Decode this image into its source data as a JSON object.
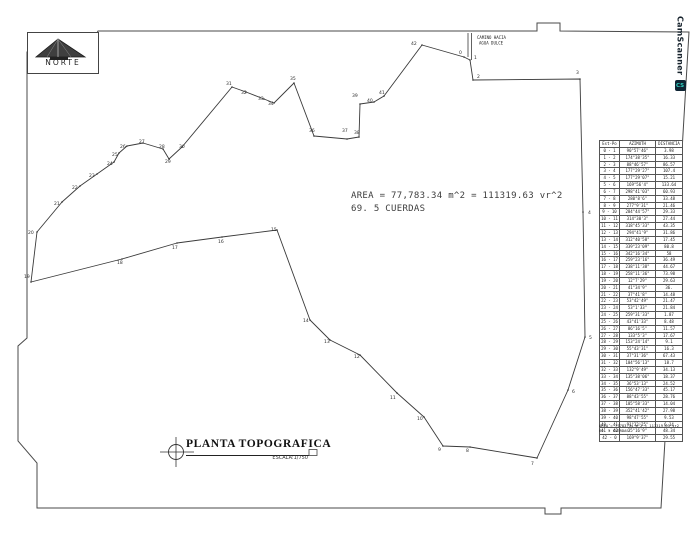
{
  "north": {
    "label": "NORTE"
  },
  "road": {
    "line1": "CAMINO HACIA",
    "line2": "AGUA DULCE"
  },
  "area_note": {
    "line1": "AREA = 77,783.34 m^2 = 111319.63 vr^2",
    "line2": "69. 5 CUERDAS"
  },
  "title_block": {
    "title": "PLANTA TOPOGRAFICA",
    "scale": "ESCALA:1/750"
  },
  "watermark": {
    "brand": "CamScanner",
    "icon": "CS"
  },
  "survey_table": {
    "headers": [
      "Est-Po",
      "AZIMUTH",
      "DISTANCIA"
    ],
    "rows": [
      [
        "0 - 1",
        "90°57'46\"",
        "3.98"
      ],
      [
        "1 - 2",
        "174°38'35\"",
        "16.33"
      ],
      [
        "2 - 3",
        "88°46'57\"",
        "86.57"
      ],
      [
        "3 - 4",
        "177°29'27\"",
        "107.4"
      ],
      [
        "4 - 5",
        "177°29'07\"",
        "15.21"
      ],
      [
        "5 - 6",
        "169°56'4\"",
        "133.64"
      ],
      [
        "6 - 7",
        "298°41'03\"",
        "60.93"
      ],
      [
        "7 - 8",
        "280°8'6\"",
        "33.48"
      ],
      [
        "8 - 9",
        "277°9'31\"",
        "21.46"
      ],
      [
        "9 - 10",
        "284°44'57\"",
        "29.33"
      ],
      [
        "10 - 11",
        "314°30'3\"",
        "27.44"
      ],
      [
        "11 - 12",
        "318°45'33\"",
        "43.35"
      ],
      [
        "12 - 13",
        "294°41'9\"",
        "31.86"
      ],
      [
        "13 - 14",
        "312°40'58\"",
        "17.45"
      ],
      [
        "14 - 15",
        "339°23'09\"",
        "80.8"
      ],
      [
        "15 - 16",
        "342°16'34\"",
        "58"
      ],
      [
        "16 - 17",
        "259°23'16\"",
        "36.49"
      ],
      [
        "17 - 18",
        "238°11'38\"",
        "44.67"
      ],
      [
        "18 - 19",
        "258°11'36\"",
        "73.98"
      ],
      [
        "19 - 20",
        "12°7'29\"",
        "29.63"
      ],
      [
        "20 - 21",
        "41°34'9\"",
        "36."
      ],
      [
        "21 - 22",
        "37°41'8\"",
        "14.48"
      ],
      [
        "22 - 23",
        "53°42'49\"",
        "21.47"
      ],
      [
        "23 - 24",
        "53°1'33\"",
        "21.84"
      ],
      [
        "24 - 25",
        "259°31'33\"",
        "1.87"
      ],
      [
        "25 - 26",
        "43°41'33\"",
        "8.48"
      ],
      [
        "26 - 27",
        "86°16'5\"",
        "11.57"
      ],
      [
        "27 - 28",
        "133°5'3\"",
        "17.67"
      ],
      [
        "28 - 29",
        "153°24'14\"",
        "9.1"
      ],
      [
        "29 - 30",
        "55°43'31\"",
        "16.3"
      ],
      [
        "30 - 31",
        "37°31'36\"",
        "67.43"
      ],
      [
        "31 - 32",
        "104°56'13\"",
        "18.7"
      ],
      [
        "32 - 33",
        "132°9'49\"",
        "34.13"
      ],
      [
        "33 - 34",
        "135°38'06\"",
        "18.37"
      ],
      [
        "34 - 35",
        "36°53'13\"",
        "24.52"
      ],
      [
        "35 - 36",
        "156°47'33\"",
        "45.17"
      ],
      [
        "36 - 37",
        "88°43'55\"",
        "28.76"
      ],
      [
        "37 - 38",
        "105°58'33\"",
        "14.04"
      ],
      [
        "38 - 39",
        "352°41'42\"",
        "27.98"
      ],
      [
        "39 - 40",
        "98°47'55\"",
        "9.53"
      ],
      [
        "40 - 41",
        "91°32'25\"",
        "6.14"
      ],
      [
        "41 - 42",
        "35°16'9\"",
        "48.34"
      ],
      [
        "42 - 0",
        "169°9'37\"",
        "29.55"
      ]
    ],
    "footer_line1": "AREA = 77783.34 m^2 = 111319.63 vr2",
    "footer_line2": "69. 5 CUERDAS"
  },
  "plot": {
    "stroke": "#3a3a3a",
    "vertices": [
      {
        "n": "0",
        "x": 464,
        "y": 57,
        "lx": 459,
        "ly": 54
      },
      {
        "n": "1",
        "x": 470,
        "y": 60,
        "lx": 474,
        "ly": 59
      },
      {
        "n": "2",
        "x": 473,
        "y": 80,
        "lx": 477,
        "ly": 78
      },
      {
        "n": "3",
        "x": 580,
        "y": 79,
        "lx": 576,
        "ly": 74
      },
      {
        "n": "4",
        "x": 583,
        "y": 212,
        "lx": 588,
        "ly": 214
      },
      {
        "n": "5",
        "x": 585,
        "y": 337,
        "lx": 589,
        "ly": 339
      },
      {
        "n": "6",
        "x": 568,
        "y": 390,
        "lx": 572,
        "ly": 393
      },
      {
        "n": "7",
        "x": 537,
        "y": 458,
        "lx": 531,
        "ly": 465
      },
      {
        "n": "8",
        "x": 470,
        "y": 447,
        "lx": 466,
        "ly": 452
      },
      {
        "n": "9",
        "x": 443,
        "y": 446,
        "lx": 438,
        "ly": 451
      },
      {
        "n": "10",
        "x": 424,
        "y": 417,
        "lx": 417,
        "ly": 420
      },
      {
        "n": "11",
        "x": 397,
        "y": 393,
        "lx": 390,
        "ly": 399
      },
      {
        "n": "12",
        "x": 360,
        "y": 355,
        "lx": 354,
        "ly": 358
      },
      {
        "n": "13",
        "x": 330,
        "y": 340,
        "lx": 324,
        "ly": 343
      },
      {
        "n": "14",
        "x": 310,
        "y": 320,
        "lx": 303,
        "ly": 322
      },
      {
        "n": "15",
        "x": 277,
        "y": 230,
        "lx": 271,
        "ly": 231
      },
      {
        "n": "16",
        "x": 222,
        "y": 237,
        "lx": 218,
        "ly": 243
      },
      {
        "n": "17",
        "x": 177,
        "y": 243,
        "lx": 172,
        "ly": 249
      },
      {
        "n": "18",
        "x": 122,
        "y": 259,
        "lx": 117,
        "ly": 264
      },
      {
        "n": "19",
        "x": 31,
        "y": 282,
        "lx": 24,
        "ly": 278
      },
      {
        "n": "20",
        "x": 37,
        "y": 232,
        "lx": 28,
        "ly": 234
      },
      {
        "n": "21",
        "x": 62,
        "y": 202,
        "lx": 54,
        "ly": 205
      },
      {
        "n": "22",
        "x": 80,
        "y": 186,
        "lx": 72,
        "ly": 189
      },
      {
        "n": "23",
        "x": 97,
        "y": 174,
        "lx": 89,
        "ly": 177
      },
      {
        "n": "24",
        "x": 114,
        "y": 162,
        "lx": 107,
        "ly": 165
      },
      {
        "n": "25",
        "x": 119,
        "y": 153,
        "lx": 112,
        "ly": 156
      },
      {
        "n": "26",
        "x": 127,
        "y": 146,
        "lx": 120,
        "ly": 148
      },
      {
        "n": "27",
        "x": 143,
        "y": 143,
        "lx": 139,
        "ly": 143
      },
      {
        "n": "28",
        "x": 163,
        "y": 149,
        "lx": 159,
        "ly": 148
      },
      {
        "n": "29",
        "x": 169,
        "y": 159,
        "lx": 165,
        "ly": 163
      },
      {
        "n": "30",
        "x": 182,
        "y": 147,
        "lx": 179,
        "ly": 148
      },
      {
        "n": "31",
        "x": 232,
        "y": 87,
        "lx": 226,
        "ly": 85
      },
      {
        "n": "32",
        "x": 246,
        "y": 92,
        "lx": 241,
        "ly": 94
      },
      {
        "n": "33",
        "x": 264,
        "y": 99,
        "lx": 258,
        "ly": 100
      },
      {
        "n": "34",
        "x": 274,
        "y": 103,
        "lx": 268,
        "ly": 105
      },
      {
        "n": "35",
        "x": 294,
        "y": 83,
        "lx": 290,
        "ly": 80
      },
      {
        "n": "36",
        "x": 314,
        "y": 136,
        "lx": 309,
        "ly": 132
      },
      {
        "n": "37",
        "x": 347,
        "y": 139,
        "lx": 342,
        "ly": 132
      },
      {
        "n": "38",
        "x": 359,
        "y": 137,
        "lx": 354,
        "ly": 134
      },
      {
        "n": "39",
        "x": 360,
        "y": 104,
        "lx": 352,
        "ly": 97
      },
      {
        "n": "40",
        "x": 374,
        "y": 102,
        "lx": 367,
        "ly": 102
      },
      {
        "n": "41",
        "x": 384,
        "y": 96,
        "lx": 379,
        "ly": 94
      },
      {
        "n": "42",
        "x": 422,
        "y": 45,
        "lx": 411,
        "ly": 45
      }
    ]
  }
}
